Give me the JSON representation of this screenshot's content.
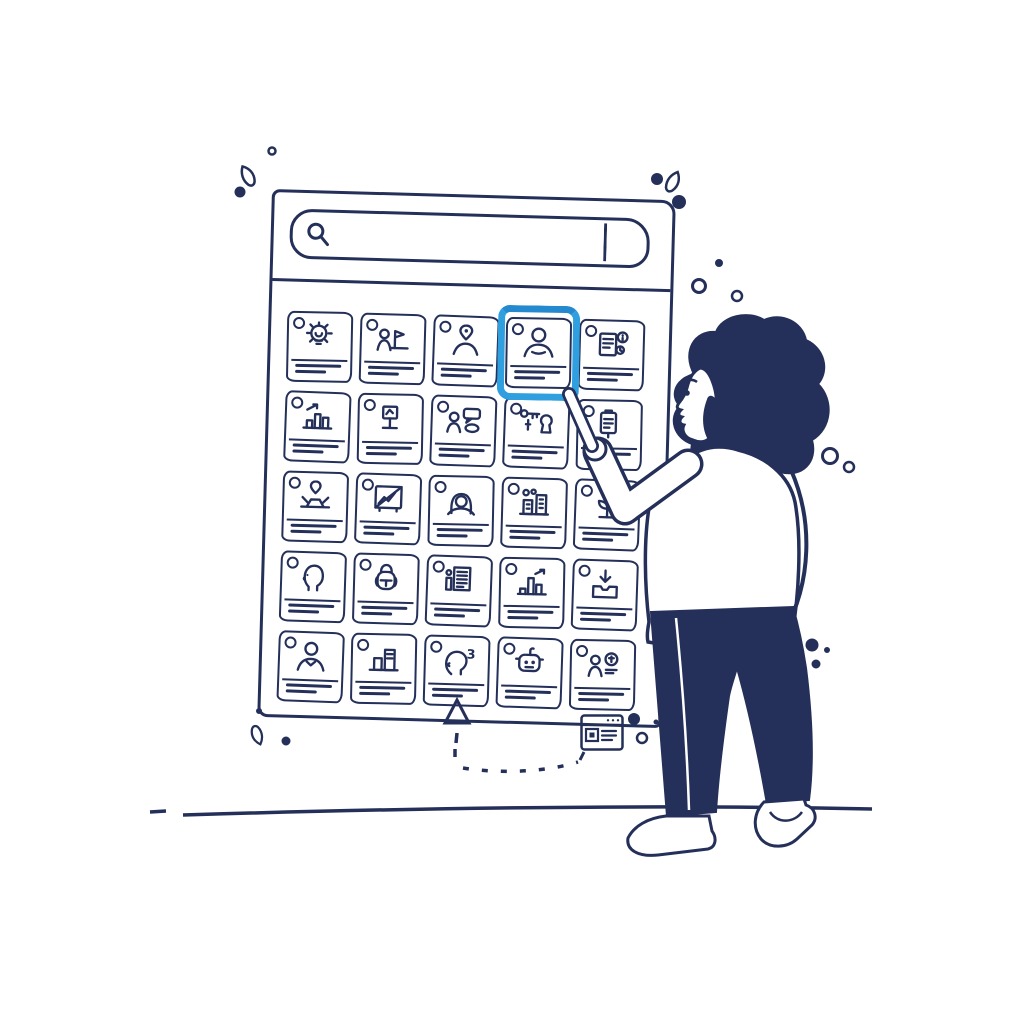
{
  "illustration": {
    "description": "Hand-drawn illustration of a woman pointing at a highlighted profile card inside a sketched browser window with a search bar and a five-by-five grid of content cards",
    "colors": {
      "ink": "#243059",
      "highlight_blue": "#2f9fe0",
      "background": "#ffffff"
    },
    "window": {
      "search": {
        "icon": "magnifier-icon",
        "value": "",
        "placeholder": "",
        "button_label": ""
      },
      "grid": {
        "rows": 5,
        "columns": 5,
        "number_badge": "3",
        "selected_card": {
          "row": 1,
          "column": 4,
          "icon": "person-portrait"
        },
        "cards": [
          {
            "icon": "lightbulb-idea"
          },
          {
            "icon": "person-presenting-chart"
          },
          {
            "icon": "person-location-pin"
          },
          {
            "icon": "person-portrait",
            "selected": true
          },
          {
            "icon": "document-info"
          },
          {
            "icon": "bar-chart-arrow"
          },
          {
            "icon": "podium-stand"
          },
          {
            "icon": "person-chat-bubbles"
          },
          {
            "icon": "key-and-lock"
          },
          {
            "icon": "clipboard-notes"
          },
          {
            "icon": "person-laptop-pin"
          },
          {
            "icon": "image-crossed-chart"
          },
          {
            "icon": "woman-portrait"
          },
          {
            "icon": "city-buildings"
          },
          {
            "icon": "plant-sprout"
          },
          {
            "icon": "man-profile"
          },
          {
            "icon": "backpack"
          },
          {
            "icon": "report-document"
          },
          {
            "icon": "growth-chart"
          },
          {
            "icon": "download-box"
          },
          {
            "icon": "person-bust"
          },
          {
            "icon": "block-chart"
          },
          {
            "icon": "head-with-number"
          },
          {
            "icon": "robot-face"
          },
          {
            "icon": "person-coin"
          }
        ]
      }
    },
    "figure": {
      "pose": "woman with curly hair pointing at selected card",
      "clothing": "light sweater, dark trousers"
    },
    "footer": {
      "pointer": "up-triangle-icon",
      "trail": "dashed-line",
      "target": "mini-browser-window-icon"
    },
    "decorations": [
      "leaf-sprig",
      "dots",
      "rings"
    ],
    "ground": "horizontal ground line"
  }
}
